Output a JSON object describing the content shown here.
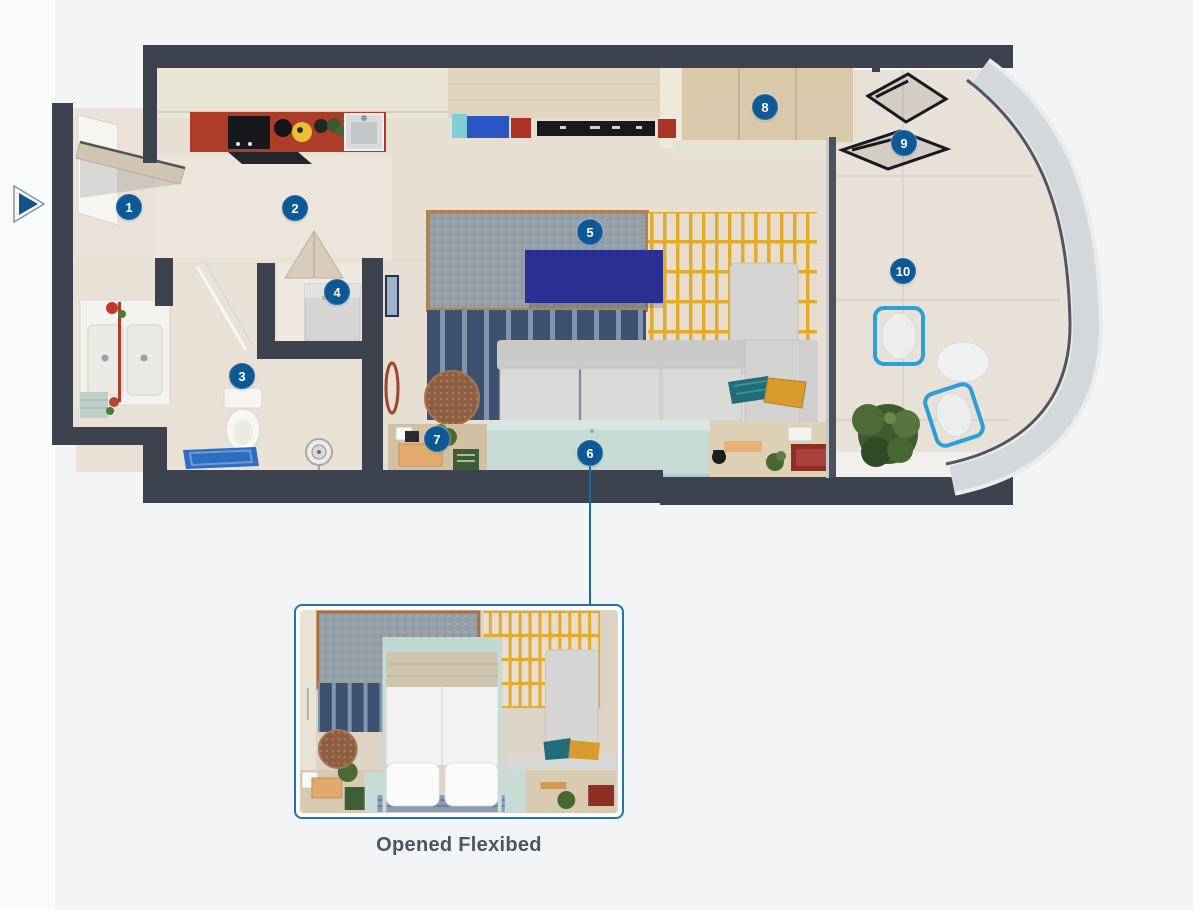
{
  "page": {
    "background": "#f2f4f6"
  },
  "carousel": {
    "play_button": {
      "icon": "play-triangle",
      "color": "#14538c"
    }
  },
  "plan": {
    "hotspot_color": "#0d5996",
    "hotspots": [
      {
        "label": "1"
      },
      {
        "label": "2"
      },
      {
        "label": "3"
      },
      {
        "label": "4"
      },
      {
        "label": "5"
      },
      {
        "label": "6"
      },
      {
        "label": "7"
      },
      {
        "label": "8"
      },
      {
        "label": "9"
      },
      {
        "label": "10"
      }
    ]
  },
  "inset": {
    "caption": "Opened Flexibed",
    "border_color": "#2272ae",
    "leader_color": "#1b6aa5"
  },
  "colors": {
    "wall_dark": "#3c434e",
    "floor_beige": "#e7dfd4",
    "kitchen_counter_red": "#ad3d28",
    "tv_navy": "#2b3192",
    "flexibed_mint": "#c6dbd5",
    "panel_yellow_line": "#e2ab2c",
    "panel_navy": "#3e5170",
    "sofa_gray": "#d9d9d7",
    "balcony_chair_blue": "#2a9fd8",
    "hull_gray": "#d5d8da"
  }
}
